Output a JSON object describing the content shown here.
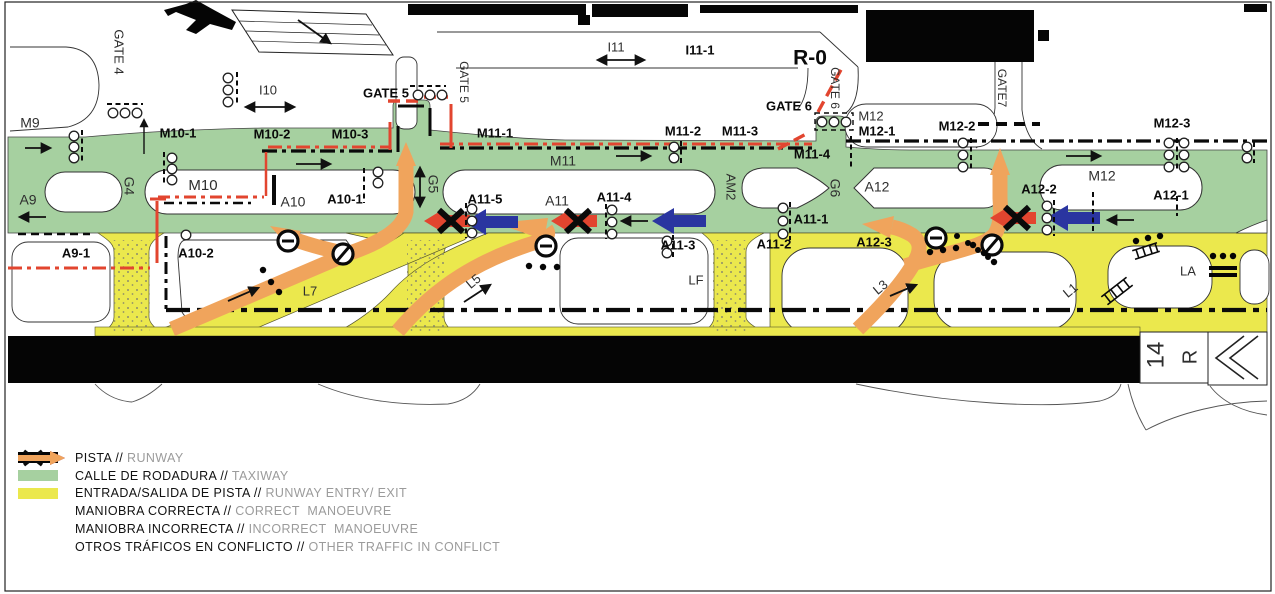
{
  "diagram": {
    "runway_designator": {
      "number": "14",
      "side": "R"
    },
    "colors": {
      "runway": "#050505",
      "taxiway_green": "#a6d0a0",
      "entry_exit_yellow": "#ebe84d",
      "correct_blue": "#2a35a0",
      "incorrect_red": "#e2452f",
      "conflict_orange": "#f0a45c"
    },
    "labels": [
      {
        "text": "GATE 4",
        "x": 118,
        "y": 52,
        "rot": 90,
        "size": 13
      },
      {
        "text": "I10",
        "x": 268,
        "y": 91,
        "size": 13
      },
      {
        "text": "GATE 5",
        "x": 386,
        "y": 94,
        "bold": true,
        "size": 13
      },
      {
        "text": "GATE 5",
        "x": 463,
        "y": 82,
        "rot": 90,
        "size": 12
      },
      {
        "text": "I11",
        "x": 616,
        "y": 48,
        "size": 13
      },
      {
        "text": "I11-1",
        "x": 700,
        "y": 51,
        "bold": true,
        "size": 13
      },
      {
        "text": "R-0",
        "x": 810,
        "y": 59,
        "bold": true,
        "size": 21
      },
      {
        "text": "GATE 6",
        "x": 789,
        "y": 107,
        "bold": true,
        "size": 13
      },
      {
        "text": "GATE 6",
        "x": 834,
        "y": 88,
        "rot": 90,
        "size": 12
      },
      {
        "text": "GATE7",
        "x": 1001,
        "y": 88,
        "rot": 90,
        "size": 12
      },
      {
        "text": "M9",
        "x": 30,
        "y": 124,
        "size": 14
      },
      {
        "text": "M10-1",
        "x": 178,
        "y": 134,
        "bold": true,
        "size": 13
      },
      {
        "text": "M10-2",
        "x": 272,
        "y": 135,
        "bold": true,
        "size": 13
      },
      {
        "text": "M10-3",
        "x": 350,
        "y": 135,
        "bold": true,
        "size": 13
      },
      {
        "text": "M11-1",
        "x": 495,
        "y": 134,
        "bold": true,
        "size": 13
      },
      {
        "text": "M11-2",
        "x": 683,
        "y": 132,
        "bold": true,
        "size": 13
      },
      {
        "text": "M11-3",
        "x": 740,
        "y": 132,
        "bold": true,
        "size": 13
      },
      {
        "text": "M12",
        "x": 871,
        "y": 117,
        "size": 13
      },
      {
        "text": "M12-1",
        "x": 877,
        "y": 132,
        "bold": true,
        "size": 13
      },
      {
        "text": "M12-2",
        "x": 957,
        "y": 127,
        "bold": true,
        "size": 13
      },
      {
        "text": "M12-3",
        "x": 1172,
        "y": 124,
        "bold": true,
        "size": 13
      },
      {
        "text": "G4",
        "x": 128,
        "y": 186,
        "rot": 90,
        "size": 14
      },
      {
        "text": "M10",
        "x": 203,
        "y": 186,
        "size": 15
      },
      {
        "text": "A9",
        "x": 28,
        "y": 201,
        "size": 14
      },
      {
        "text": "A10",
        "x": 293,
        "y": 203,
        "size": 14
      },
      {
        "text": "A10-1",
        "x": 345,
        "y": 200,
        "bold": true,
        "size": 13
      },
      {
        "text": "G5",
        "x": 432,
        "y": 184,
        "rot": 90,
        "size": 14
      },
      {
        "text": "M11",
        "x": 563,
        "y": 162,
        "size": 14
      },
      {
        "text": "A11-5",
        "x": 485,
        "y": 200,
        "bold": true,
        "size": 13
      },
      {
        "text": "A11",
        "x": 557,
        "y": 202,
        "size": 14
      },
      {
        "text": "A11-4",
        "x": 614,
        "y": 198,
        "bold": true,
        "size": 13
      },
      {
        "text": "M11-4",
        "x": 812,
        "y": 155,
        "bold": true,
        "size": 13
      },
      {
        "text": "AM2",
        "x": 730,
        "y": 187,
        "rot": 90,
        "size": 13
      },
      {
        "text": "G6",
        "x": 834,
        "y": 188,
        "rot": 90,
        "size": 14
      },
      {
        "text": "A11-1",
        "x": 811,
        "y": 220,
        "bold": true,
        "size": 13
      },
      {
        "text": "A11-2",
        "x": 774,
        "y": 245,
        "bold": true,
        "size": 13
      },
      {
        "text": "A11-3",
        "x": 678,
        "y": 246,
        "bold": true,
        "size": 13
      },
      {
        "text": "A12",
        "x": 877,
        "y": 188,
        "size": 14
      },
      {
        "text": "A12-2",
        "x": 1039,
        "y": 190,
        "bold": true,
        "size": 13
      },
      {
        "text": "M12",
        "x": 1102,
        "y": 177,
        "size": 14
      },
      {
        "text": "A12-1",
        "x": 1171,
        "y": 196,
        "bold": true,
        "size": 13
      },
      {
        "text": "A12-3",
        "x": 874,
        "y": 243,
        "bold": true,
        "size": 13
      },
      {
        "text": "A9-1",
        "x": 76,
        "y": 254,
        "bold": true,
        "size": 13
      },
      {
        "text": "A10-2",
        "x": 196,
        "y": 254,
        "bold": true,
        "size": 13
      },
      {
        "text": "L7",
        "x": 310,
        "y": 292,
        "size": 13
      },
      {
        "text": "L5",
        "x": 474,
        "y": 282,
        "rot": -40,
        "size": 13
      },
      {
        "text": "LF",
        "x": 696,
        "y": 281,
        "size": 13
      },
      {
        "text": "L3",
        "x": 881,
        "y": 288,
        "rot": -40,
        "size": 13
      },
      {
        "text": "L1",
        "x": 1071,
        "y": 291,
        "rot": -40,
        "size": 13
      },
      {
        "text": "LA",
        "x": 1188,
        "y": 272,
        "size": 13
      },
      {
        "text": "14",
        "x": 1157,
        "y": 355,
        "rot": -90,
        "size": 24
      },
      {
        "text": "R",
        "x": 1191,
        "y": 357,
        "rot": -90,
        "size": 20
      }
    ]
  },
  "legend": {
    "separator": "//",
    "items": [
      {
        "type": "swatch",
        "color": "#050505",
        "label_es": "PISTA",
        "label_en": "RUNWAY"
      },
      {
        "type": "swatch",
        "color": "#a6d0a0",
        "label_es": "CALLE DE RODADURA",
        "label_en": "TAXIWAY"
      },
      {
        "type": "swatch",
        "color": "#ebe84d",
        "label_es": "ENTRADA/SALIDA DE PISTA",
        "label_en": "RUNWAY ENTRY/ EXIT"
      },
      {
        "type": "arrow",
        "color": "#2a35a0",
        "label_es": "MANIOBRA CORRECTA",
        "label_en": "CORRECT  MANOEUVRE"
      },
      {
        "type": "arrow-x",
        "color": "#e2452f",
        "label_es": "MANIOBRA INCORRECTA",
        "label_en": "INCORRECT  MANOEUVRE"
      },
      {
        "type": "arrow",
        "color": "#f0a45c",
        "label_es": "OTROS TRÁFICOS EN CONFLICTO",
        "label_en": "OTHER TRAFFIC IN CONFLICT"
      }
    ]
  }
}
